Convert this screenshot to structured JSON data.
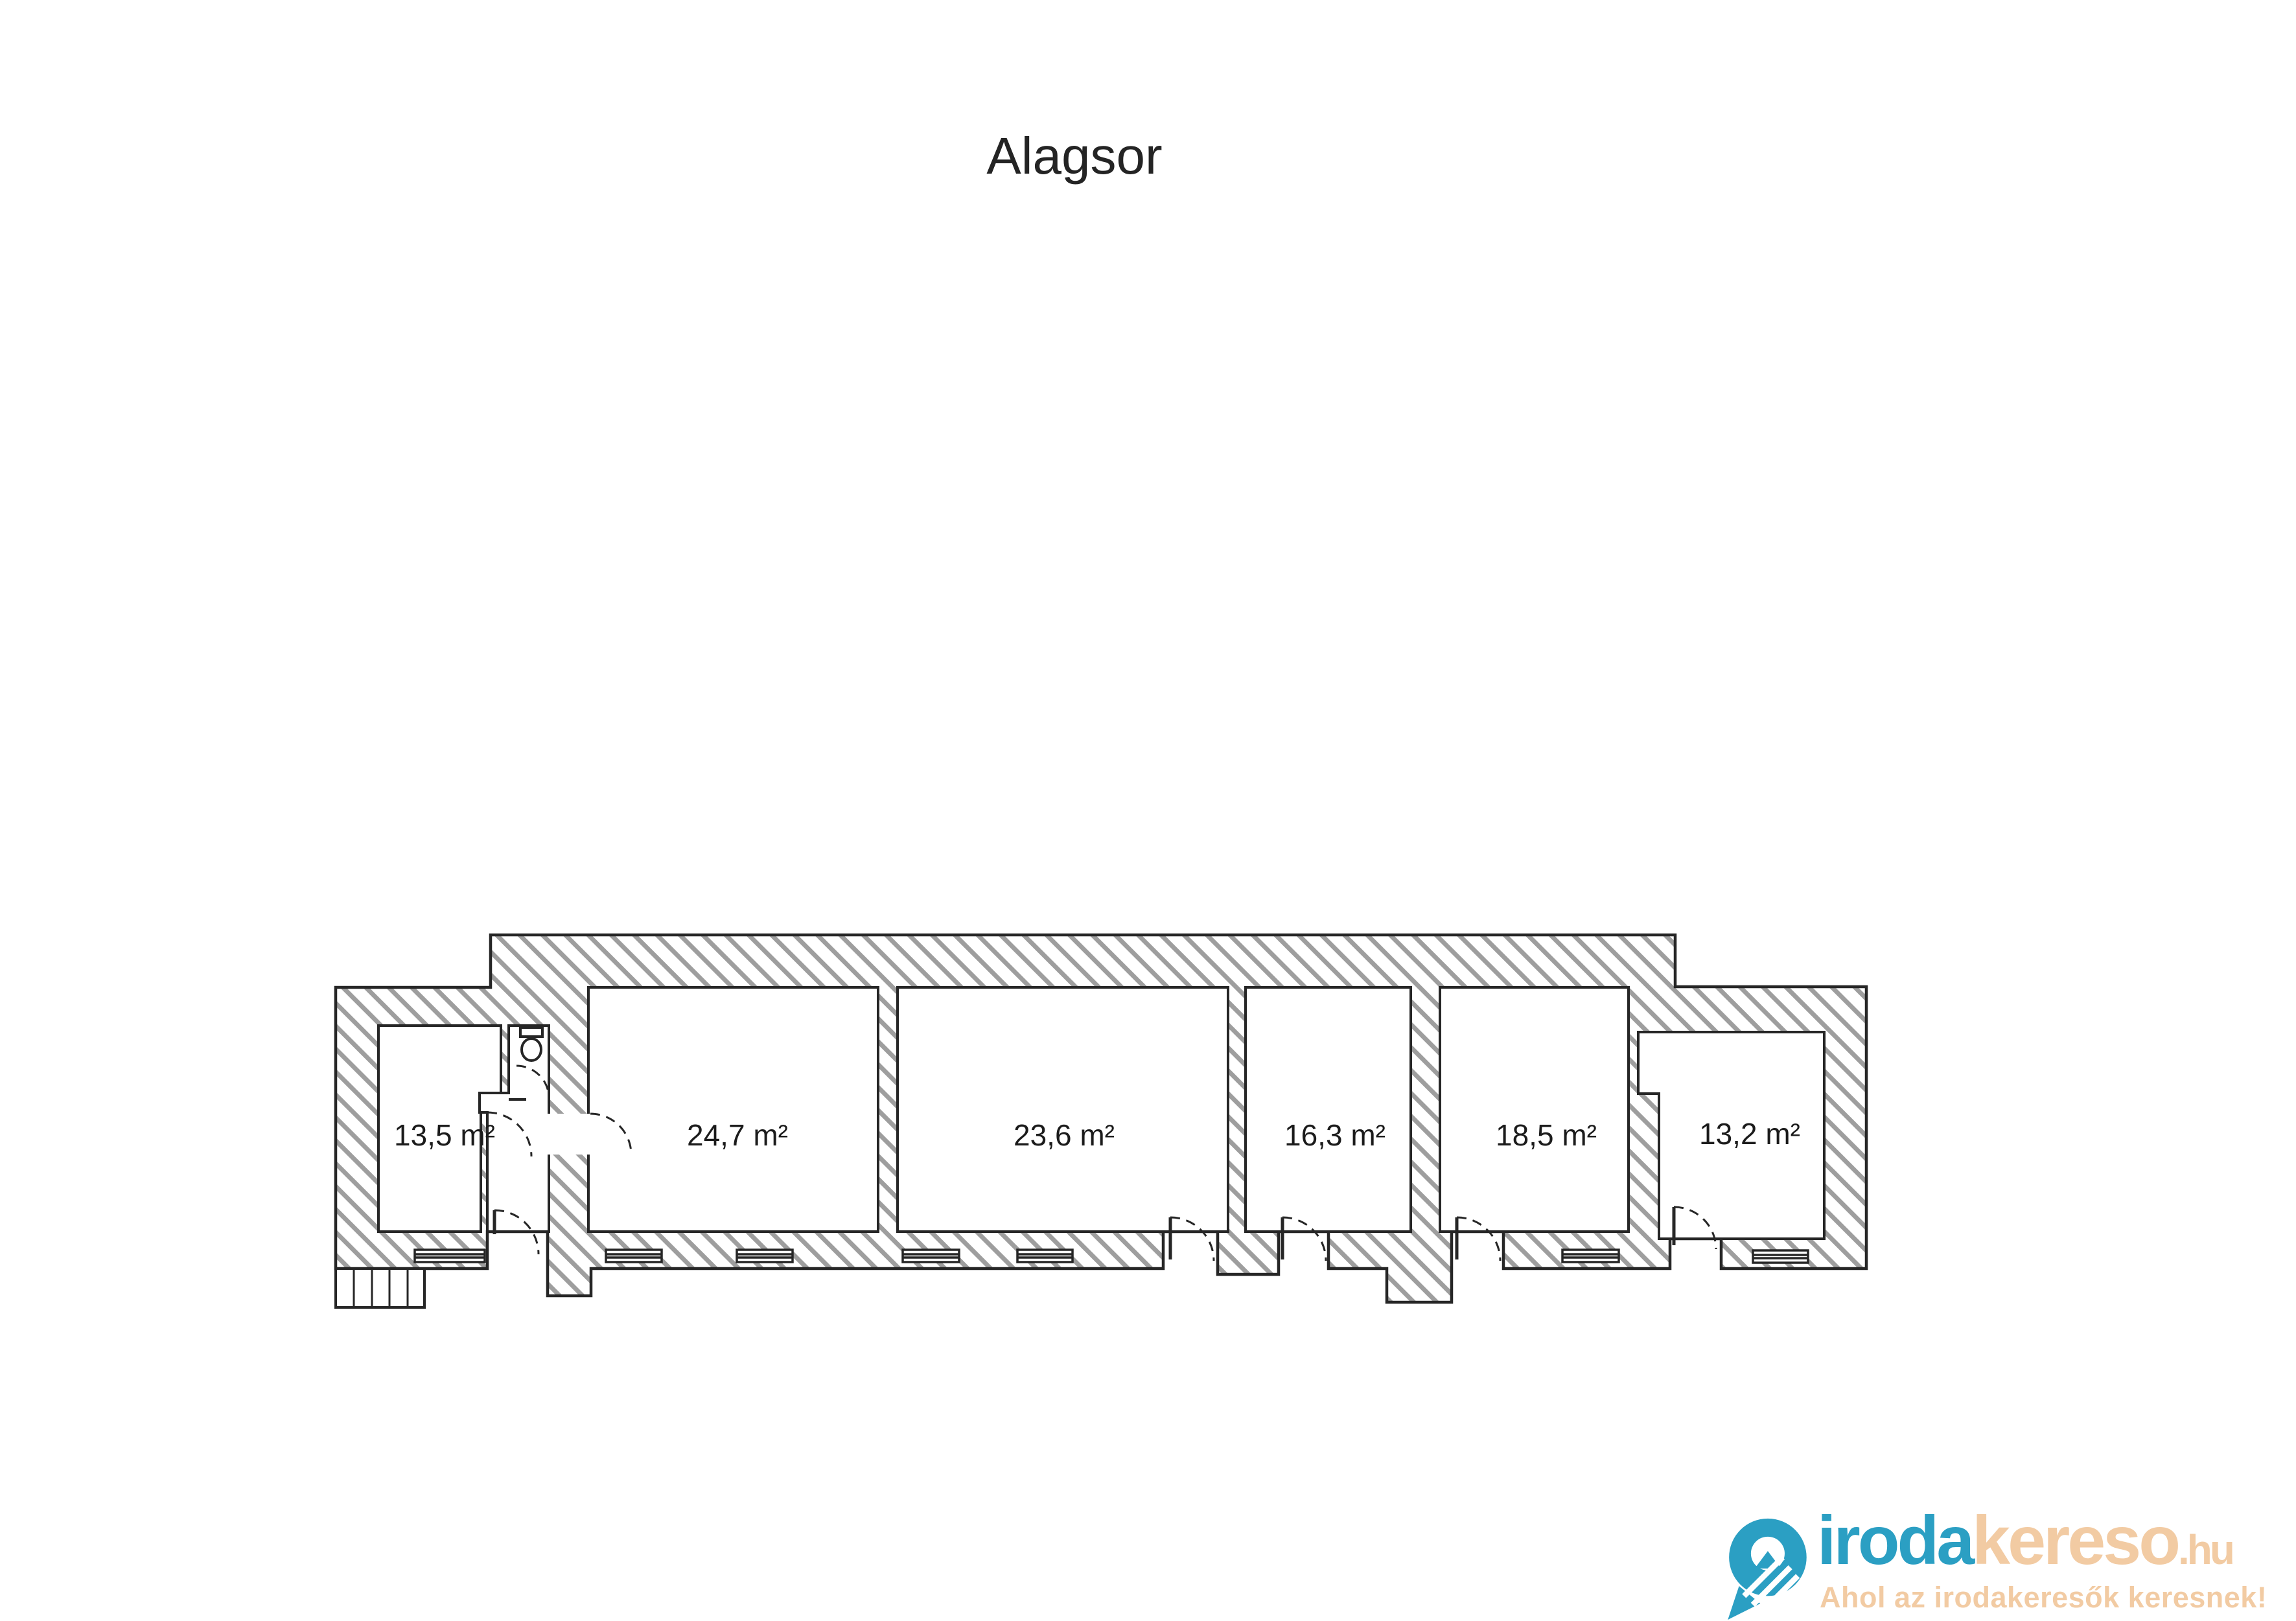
{
  "title": "Alagsor",
  "floor_plan": {
    "rooms": [
      {
        "id": "room-1",
        "area_label": "13,5 m²"
      },
      {
        "id": "room-2",
        "area_label": "24,7 m²"
      },
      {
        "id": "room-3",
        "area_label": "23,6 m²"
      },
      {
        "id": "room-4",
        "area_label": "16,3 m²"
      },
      {
        "id": "room-5",
        "area_label": "18,5 m²"
      },
      {
        "id": "room-6",
        "area_label": "13,2 m²"
      }
    ],
    "features": {
      "toilet": "toilet-icon",
      "stairs": "entrance-stairs",
      "window_count": 7,
      "door_count": 8
    }
  },
  "logo": {
    "brand_primary": "iroda",
    "brand_secondary": "kereso",
    "brand_tld": ".hu",
    "tagline": "Ahol az irodakeresők keresnek!",
    "colors": {
      "teal": "#2b9fc3",
      "tan": "#f2cba3"
    }
  }
}
